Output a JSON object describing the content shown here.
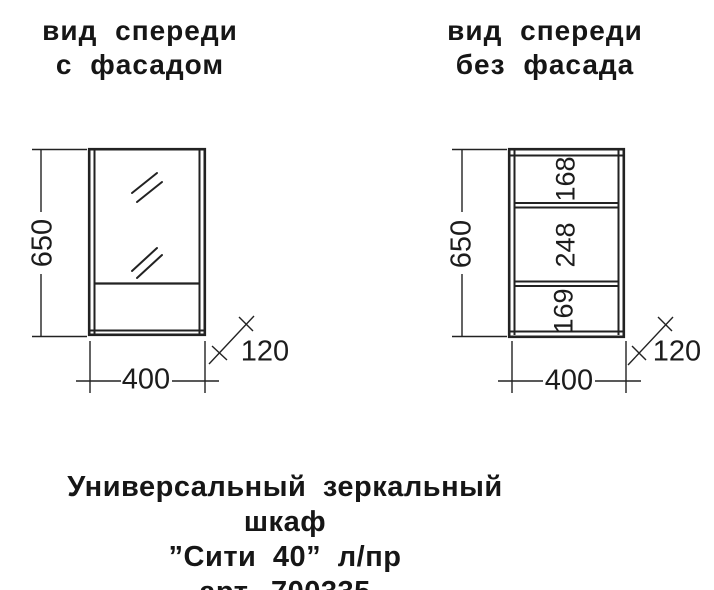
{
  "views": {
    "left": {
      "title_line1": "вид спереди",
      "title_line2": "с фасадом",
      "height_dim": "650",
      "width_dim": "400",
      "depth_dim": "120"
    },
    "right": {
      "title_line1": "вид спереди",
      "title_line2": "без фасада",
      "height_dim": "650",
      "width_dim": "400",
      "depth_dim": "120",
      "shelf_dims": [
        "168",
        "248",
        "169"
      ]
    }
  },
  "caption": {
    "line1": "Универсальный зеркальный шкаф",
    "line2": "”Сити 40” л/пр",
    "line3": "арт. 700335"
  }
}
